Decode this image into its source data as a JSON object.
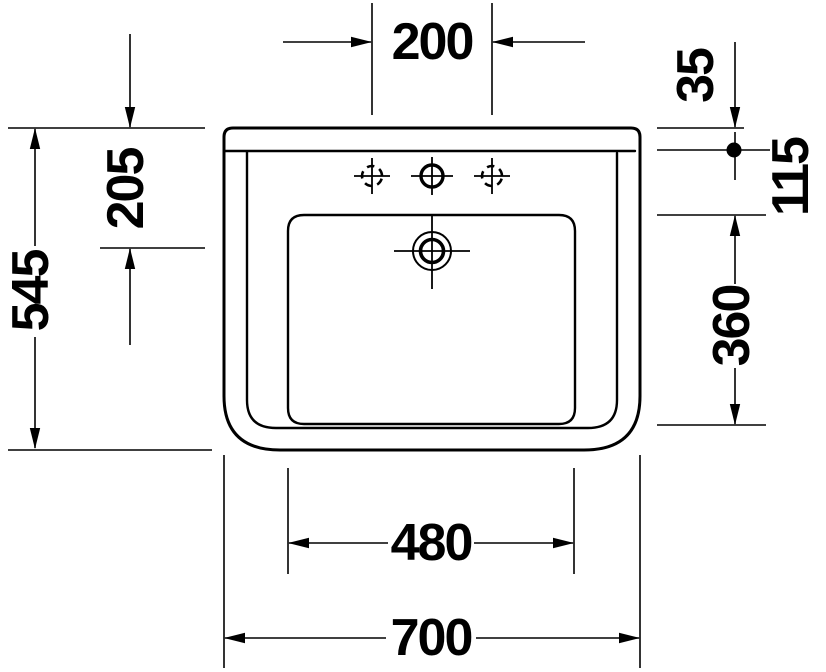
{
  "dimensions": {
    "tap_hole_spacing": "200",
    "rim_to_fixing_hole": "35",
    "fixing_hole_to_bowl_edge": "115",
    "rim_to_drain_center": "205",
    "overall_depth": "545",
    "bowl_depth": "360",
    "bowl_width": "480",
    "overall_width": "700"
  }
}
